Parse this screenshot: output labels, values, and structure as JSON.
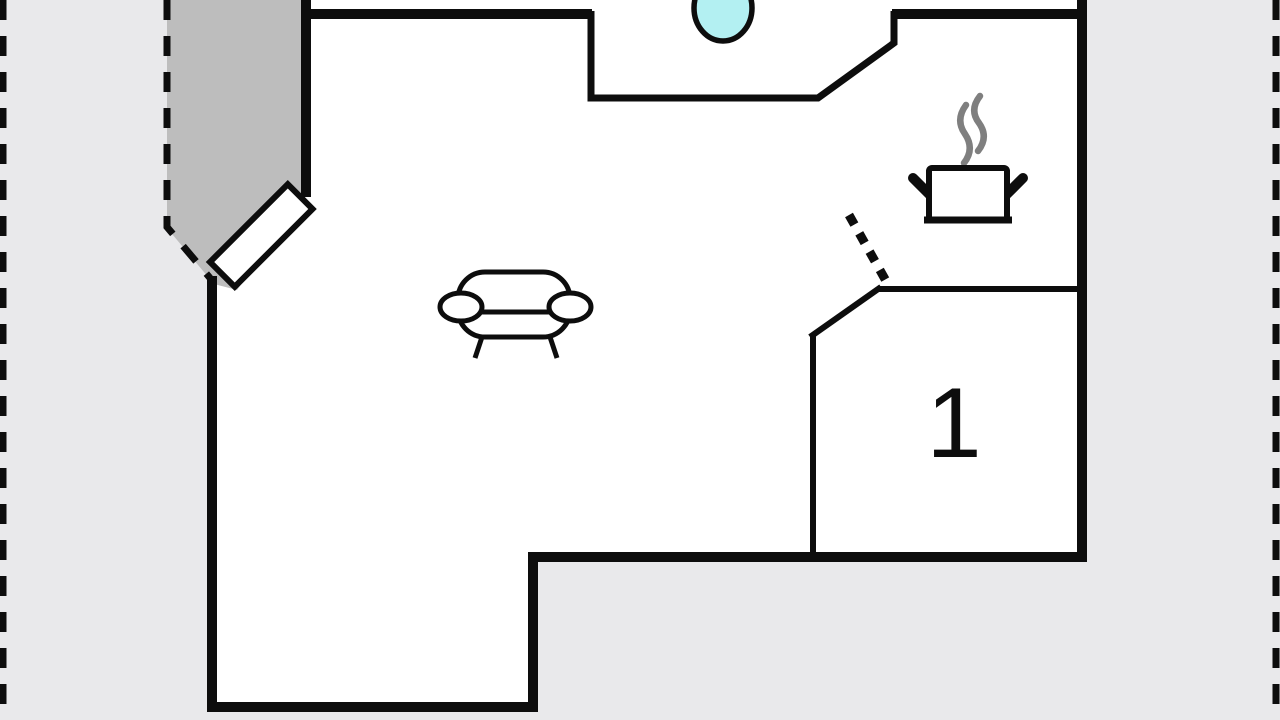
{
  "floorplan": {
    "title": "apartment-floor-plan",
    "room_label": "1",
    "colors": {
      "background": "#e9e9eb",
      "interior": "#ffffff",
      "wall": "#0d0d0d",
      "terrace": "#bdbdbd",
      "sink": "#b3f0f2",
      "steam": "#7f7f7f"
    },
    "icons": [
      {
        "name": "sofa-icon",
        "meaning": "sofa / living area"
      },
      {
        "name": "cooking-pot-icon",
        "meaning": "kitchen / stove"
      },
      {
        "name": "sink-icon",
        "meaning": "sink basin"
      },
      {
        "name": "door-leaf",
        "meaning": "entry door"
      }
    ]
  }
}
